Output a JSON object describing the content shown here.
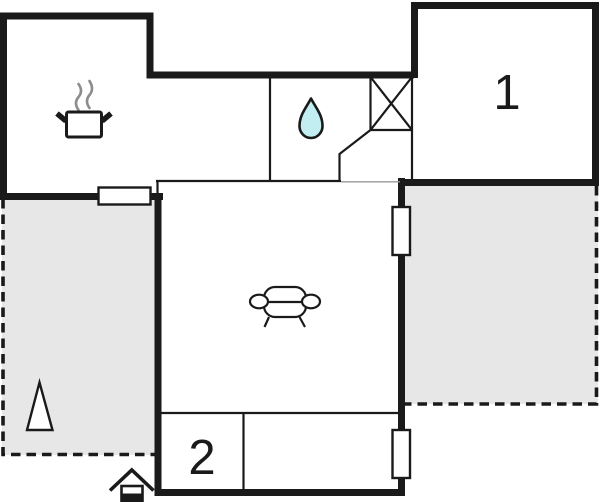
{
  "floorplan": {
    "rooms": [
      {
        "name": "bedroom-1",
        "label": "1"
      },
      {
        "name": "bedroom-2",
        "label": "2"
      },
      {
        "name": "kitchen",
        "label": "",
        "icon": "cooking-pot-icon"
      },
      {
        "name": "bathroom",
        "label": "",
        "icon": "water-drop-icon"
      },
      {
        "name": "living-room",
        "label": "",
        "icon": "sofa-icon"
      },
      {
        "name": "hall",
        "label": ""
      }
    ],
    "outdoor": [
      {
        "name": "terrace-left",
        "icon": "tree-icon"
      },
      {
        "name": "terrace-right",
        "icon": ""
      }
    ],
    "entrance": {
      "icon": "entrance-house-icon"
    },
    "fixtures": [
      {
        "name": "wardrobe",
        "icon": "crossed-box-icon"
      },
      {
        "name": "window",
        "count": 3
      }
    ],
    "colors": {
      "wall": "#1a1a1a",
      "terrace": "#e7e7e7",
      "water": "#c2eef2",
      "steam": "#8c8c8c",
      "threshold": "#999999",
      "paper": "#ffffff"
    }
  }
}
